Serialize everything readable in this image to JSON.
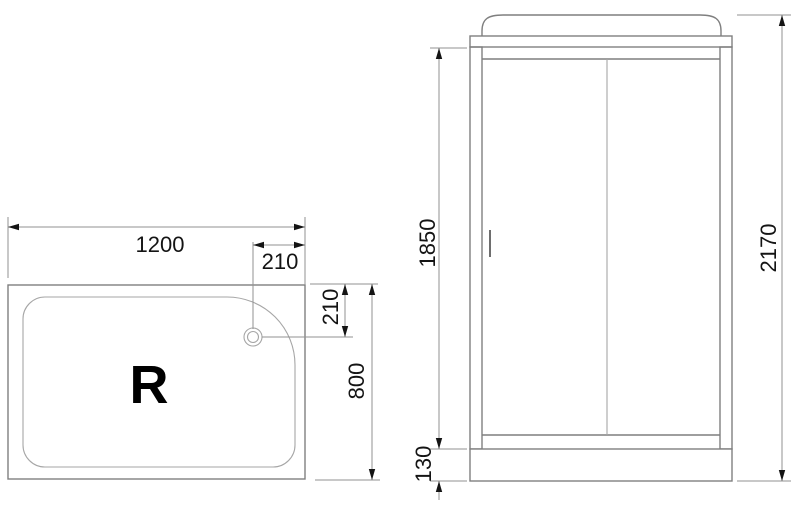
{
  "drawing": {
    "tray_view": {
      "marking": "R",
      "width_label": "1200",
      "drain_offset_x_label": "210",
      "drain_offset_y_label": "210",
      "depth_label": "800"
    },
    "cabin_view": {
      "door_height_label": "1850",
      "base_height_label": "130",
      "total_height_label": "2170"
    },
    "colors": {
      "background": "#ffffff",
      "line": "#7f7f7f",
      "inner_line": "#a6a6a6",
      "dim_line": "#929292",
      "text": "#141414",
      "marking": "#000000",
      "handle": "#6e6e6e"
    }
  }
}
